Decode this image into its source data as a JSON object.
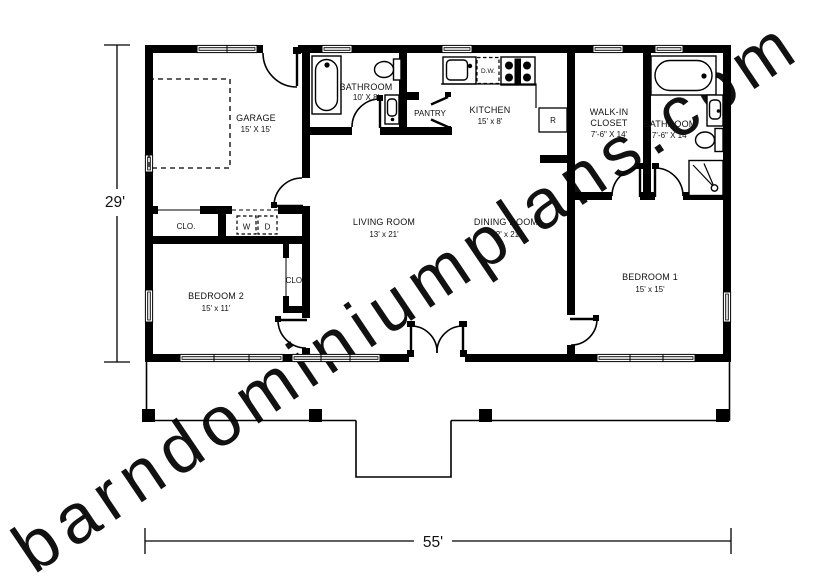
{
  "watermark": "barndominiumplans.com",
  "dimensions": {
    "height_label": "29'",
    "width_label": "55'"
  },
  "rooms": {
    "garage": {
      "name": "GARAGE",
      "size": "15' X 15'"
    },
    "bathroom_top": {
      "name": "BATHROOM",
      "size": "10' X 8'"
    },
    "pantry": {
      "name": "PANTRY"
    },
    "kitchen": {
      "name": "KITCHEN",
      "size": "15' x 8'"
    },
    "walk_in_closet": {
      "name_line1": "WALK-IN",
      "name_line2": "CLOSET",
      "size": "7'-6\" X 14'"
    },
    "bathroom_right": {
      "name": "BATHROOM",
      "size": "7'-6\" X 14'"
    },
    "living_room": {
      "name": "LIVING ROOM",
      "size": "13' x 21'"
    },
    "dining_room": {
      "name": "DINING ROOM",
      "size": "12' x 21'"
    },
    "bedroom_1": {
      "name": "BEDROOM 1",
      "size": "15' x 15'"
    },
    "bedroom_2": {
      "name": "BEDROOM 2",
      "size": "15' x 11'"
    },
    "hall_closet": {
      "name": "CLO."
    },
    "bedroom2_closet": {
      "name": "CLO."
    }
  },
  "appliances": {
    "washer": "W",
    "dryer": "D",
    "dishwasher": "D.W.",
    "refrigerator": "R"
  },
  "colors": {
    "wall": "#000000",
    "watermark": "#e0e0e0"
  }
}
